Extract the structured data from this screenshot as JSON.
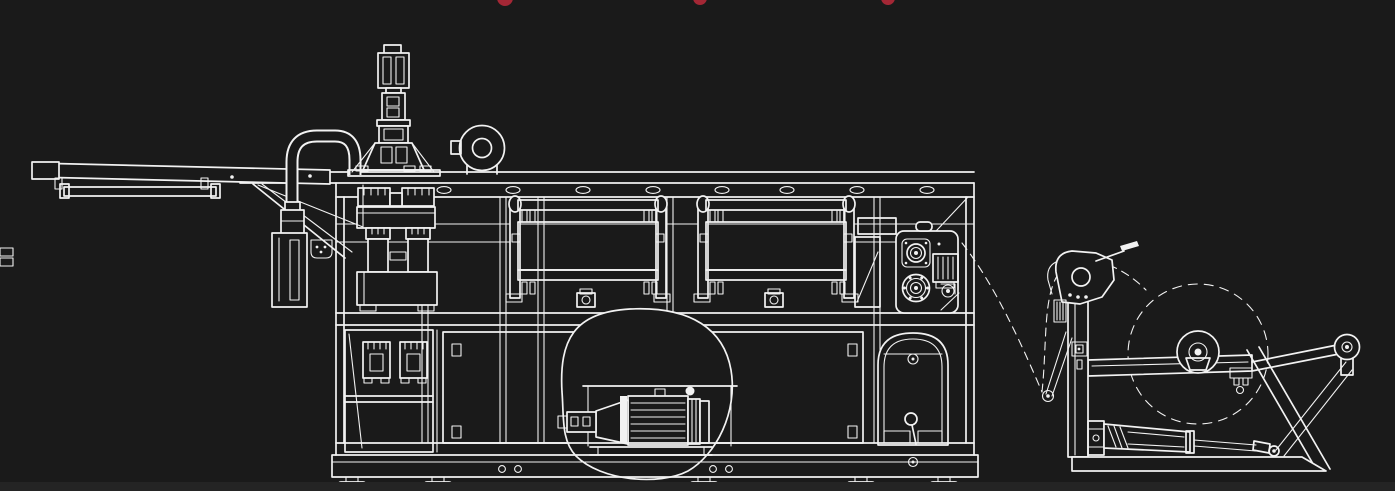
{
  "meta": {
    "title": "Thermoforming machine with roll-feed unwinder - white line engineering side elevation on dark background",
    "drawing_style": "technical outline drawing, no visible text or dimensions"
  },
  "colors": {
    "background": "#1a1a1a",
    "line": "#f2f2f2",
    "accent_red": "#a32735",
    "bottom_strip": "#242424"
  },
  "watermark": {
    "note": "three clipped red dots along top edge",
    "dots": [
      {
        "x": "505"
      },
      {
        "x": "700"
      },
      {
        "x": "888"
      }
    ]
  },
  "parts": [
    "output-conveyor-table",
    "hanging-rail",
    "vacuum-pipe",
    "feeder-tower",
    "blower-fan",
    "machine-frame",
    "forming-press",
    "heater-module-1",
    "heater-module-2",
    "lower-cabinet",
    "drive-motor-callout",
    "pull-roll-station",
    "arched-cabinet-door",
    "film-web-path",
    "roll-unwinder",
    "material-roll",
    "dancer-arm",
    "hydraulic-cylinder",
    "idler-roller",
    "machine-feet"
  ]
}
